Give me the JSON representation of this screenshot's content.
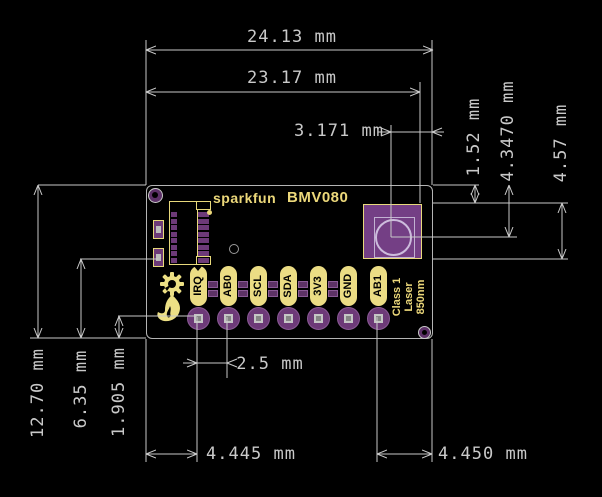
{
  "title": "SparkFun BMV080 board dimensional drawing",
  "colors": {
    "background": "#000000",
    "dimension_lines": "#c9c9c9",
    "pad_purple": "#6d3a78",
    "sensor_purple": "#743f85",
    "silkscreen_yellow": "#ecd87a"
  },
  "board": {
    "silk_brand": "sparkfun",
    "silk_product": "BMV080",
    "pins": [
      "IRQ",
      "AB0",
      "SCL",
      "SDA",
      "3V3",
      "GND",
      "AB1"
    ],
    "laser_label": [
      "Class 1",
      "Laser",
      "850nm"
    ]
  },
  "dimensions": {
    "board_width": "24.13 mm",
    "left_edge_to_sensor_right": "23.17 mm",
    "circle_center_to_right_edge": "3.171 mm",
    "top_edge_to_sensor_top": "1.52 mm",
    "top_edge_to_circle_center": "4.3470 mm",
    "sensor_height": "4.57 mm",
    "board_height": "12.70 mm",
    "bottom_to_board_middle": "6.35 mm",
    "bottom_to_pin_row": "1.905 mm",
    "pin_pitch": "2.5 mm",
    "left_edge_to_first_pin": "4.445 mm",
    "last_pin_to_right_edge": "4.450 mm"
  }
}
